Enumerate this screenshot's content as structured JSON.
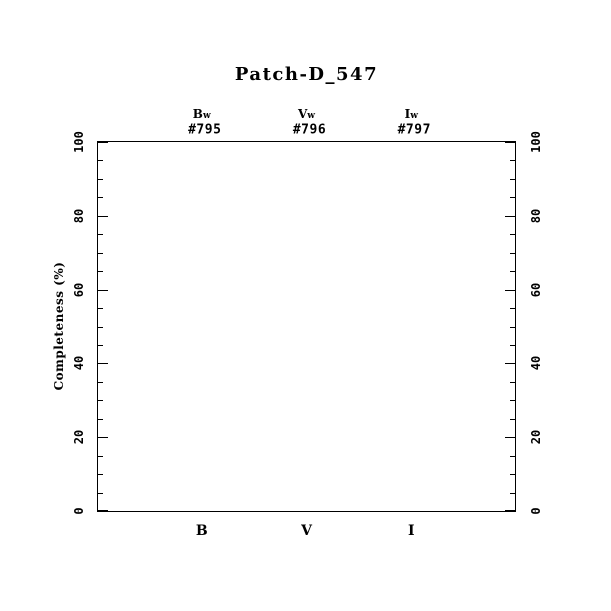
{
  "figure": {
    "title": "Patch-D_547",
    "ylabel": "Completeness (%)"
  },
  "colors": {
    "foreground": "#000000",
    "background": "#ffffff"
  },
  "chart_data": {
    "type": "line",
    "title": "Patch-D_547",
    "xlabel": "",
    "ylabel": "Completeness (%)",
    "ylim": [
      0,
      100
    ],
    "y_major_ticks": [
      0,
      20,
      40,
      60,
      80,
      100
    ],
    "y_minor_tick_step": 5,
    "grid": false,
    "legend": null,
    "x_categories": [
      "B",
      "V",
      "I"
    ],
    "x_category_positions_frac": [
      0.25,
      0.5,
      0.75
    ],
    "top_columns": [
      {
        "filter": "Bw",
        "number": "#795"
      },
      {
        "filter": "Vw",
        "number": "#796"
      },
      {
        "filter": "Iw",
        "number": "#797"
      }
    ],
    "series": []
  }
}
